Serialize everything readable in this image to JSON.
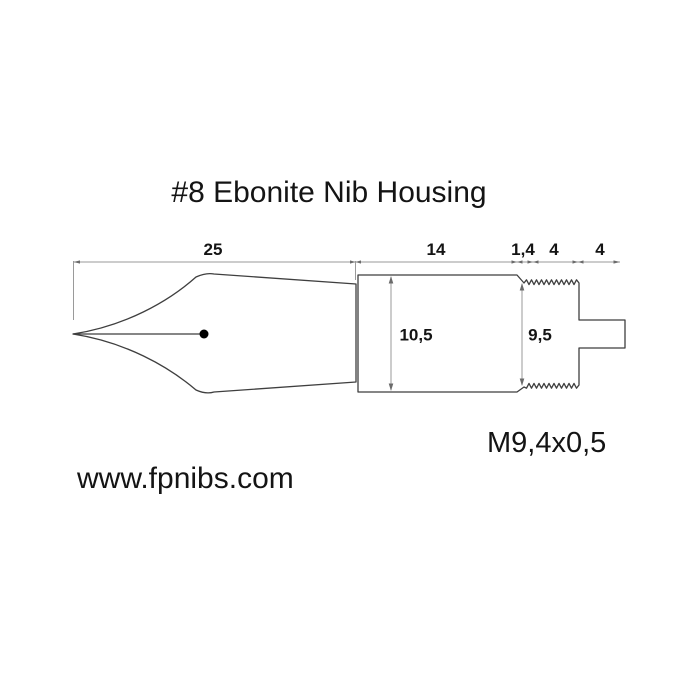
{
  "title": "#8 Ebonite Nib Housing",
  "dimensions": {
    "nib_length": "25",
    "body_length": "14",
    "chamfer_length": "1,4",
    "thread_length": "4",
    "tab_length": "4",
    "body_diameter": "10,5",
    "thread_diameter": "9,5"
  },
  "thread_spec": "M9,4x0,5",
  "website": "www.fpnibs.com",
  "colors": {
    "background": "#ffffff",
    "part_outline": "#3f3f3f",
    "dimension_lines": "#9a9a9a",
    "dimension_marks": "#6b6b6b",
    "text": "#141414",
    "breather_hole": "#000000"
  }
}
